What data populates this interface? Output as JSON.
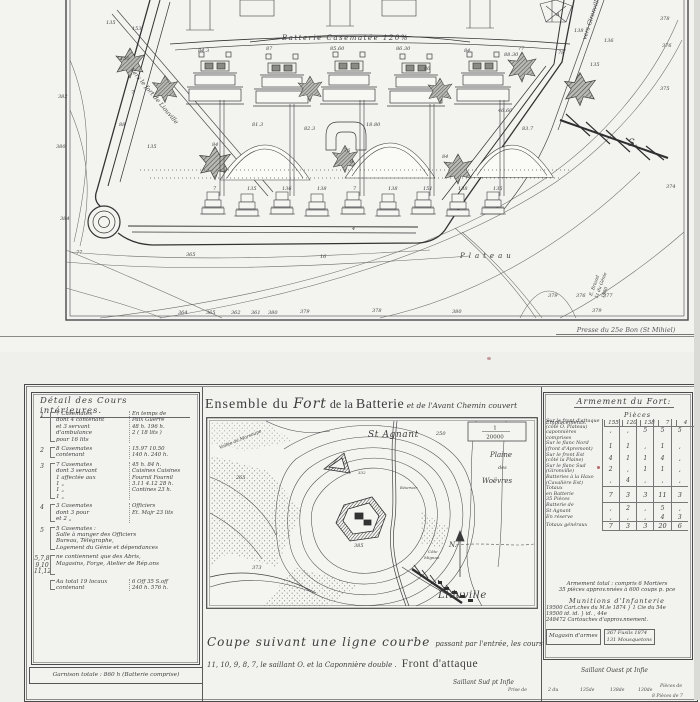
{
  "imprint": "Presse du 25e Bon (St Mihiel)",
  "fort_plan": {
    "top_label": "Batterie Casematée 120%",
    "road_left_label": "Vers le fort de Liouville",
    "road_right_label": "vers Gironville",
    "south_label": "S.",
    "plateau_label": "Plateau",
    "signature": [
      "E. Briand",
      "Lt du Génie",
      "1880"
    ],
    "labels": [
      {
        "t": "135",
        "x": 106,
        "y": 24
      },
      {
        "t": "153",
        "x": 132,
        "y": 30
      },
      {
        "t": "150",
        "x": 120,
        "y": 60
      },
      {
        "t": "7",
        "x": 131,
        "y": 94
      },
      {
        "t": "88",
        "x": 119,
        "y": 126
      },
      {
        "t": "135",
        "x": 147,
        "y": 148
      },
      {
        "t": "382",
        "x": 58,
        "y": 98
      },
      {
        "t": "380",
        "x": 56,
        "y": 148
      },
      {
        "t": "384",
        "x": 60,
        "y": 220
      },
      {
        "t": "77",
        "x": 76,
        "y": 254
      },
      {
        "t": "84.3",
        "x": 198,
        "y": 52
      },
      {
        "t": "87",
        "x": 266,
        "y": 50
      },
      {
        "t": "85.60",
        "x": 330,
        "y": 50
      },
      {
        "t": "86.30",
        "x": 396,
        "y": 50
      },
      {
        "t": "84",
        "x": 464,
        "y": 52
      },
      {
        "t": "86",
        "x": 424,
        "y": 70
      },
      {
        "t": "88.30",
        "x": 504,
        "y": 56
      },
      {
        "t": "A",
        "x": 556,
        "y": 16
      },
      {
        "t": "77",
        "x": 518,
        "y": 50
      },
      {
        "t": "78",
        "x": 558,
        "y": 54
      },
      {
        "t": "135",
        "x": 590,
        "y": 66
      },
      {
        "t": "136",
        "x": 604,
        "y": 42
      },
      {
        "t": "138",
        "x": 574,
        "y": 32
      },
      {
        "t": "81.3",
        "x": 252,
        "y": 126
      },
      {
        "t": "82.3",
        "x": 304,
        "y": 130
      },
      {
        "t": "18.80",
        "x": 366,
        "y": 126
      },
      {
        "t": "76",
        "x": 344,
        "y": 152
      },
      {
        "t": "9",
        "x": 350,
        "y": 163
      },
      {
        "t": "84",
        "x": 212,
        "y": 146
      },
      {
        "t": "84",
        "x": 442,
        "y": 158
      },
      {
        "t": "46.60",
        "x": 498,
        "y": 112
      },
      {
        "t": "83.7",
        "x": 522,
        "y": 130
      },
      {
        "t": "7",
        "x": 213,
        "y": 190
      },
      {
        "t": "135",
        "x": 247,
        "y": 190
      },
      {
        "t": "136",
        "x": 282,
        "y": 190
      },
      {
        "t": "138",
        "x": 317,
        "y": 190
      },
      {
        "t": "7",
        "x": 353,
        "y": 190
      },
      {
        "t": "138",
        "x": 388,
        "y": 190
      },
      {
        "t": "151",
        "x": 423,
        "y": 190
      },
      {
        "t": "138",
        "x": 458,
        "y": 190
      },
      {
        "t": "135",
        "x": 493,
        "y": 190
      },
      {
        "t": "364",
        "x": 178,
        "y": 314
      },
      {
        "t": "365",
        "x": 206,
        "y": 314
      },
      {
        "t": "362",
        "x": 231,
        "y": 314
      },
      {
        "t": "361",
        "x": 251,
        "y": 314
      },
      {
        "t": "380",
        "x": 268,
        "y": 314
      },
      {
        "t": "379",
        "x": 300,
        "y": 313
      },
      {
        "t": "378",
        "x": 372,
        "y": 312
      },
      {
        "t": "380",
        "x": 452,
        "y": 313
      },
      {
        "t": "379",
        "x": 548,
        "y": 297
      },
      {
        "t": "376",
        "x": 576,
        "y": 297
      },
      {
        "t": "377",
        "x": 603,
        "y": 297
      },
      {
        "t": "379",
        "x": 592,
        "y": 312
      },
      {
        "t": "378",
        "x": 660,
        "y": 20
      },
      {
        "t": "376",
        "x": 662,
        "y": 47
      },
      {
        "t": "375",
        "x": 660,
        "y": 90
      },
      {
        "t": "374",
        "x": 666,
        "y": 188
      },
      {
        "t": "16",
        "x": 320,
        "y": 258
      },
      {
        "t": "365",
        "x": 186,
        "y": 256
      },
      {
        "t": "4",
        "x": 352,
        "y": 230
      }
    ]
  },
  "left_table": {
    "title": "Détail des Cours intérieures.",
    "rows": [
      {
        "num": "1",
        "desc": [
          "7 Casemates",
          "dont 4 contenant",
          "et 3 servant",
          "d'ambulance",
          "pour 16 lits"
        ],
        "vals": [
          "En temps de",
          "Paix      Guerre",
          "48 h.      196 h.",
          "2 ( 18 lits )"
        ]
      },
      {
        "num": "2",
        "desc": [
          "8 Casemates",
          "contenant"
        ],
        "vals": [
          "15.97      10.50",
          "140 h.     240 h."
        ]
      },
      {
        "num": "3",
        "desc": [
          "7 Casemates",
          "dont 3 servant",
          "1 affectée aux",
          "1        „",
          "1        „",
          "1        „"
        ],
        "vals": [
          "45 h.       84 h.",
          "Cuisines  Cuisines",
          "Fournil     Fournil",
          "3.11 4.12   28 h.",
          "Cantines    23 h."
        ]
      },
      {
        "num": "4",
        "desc": [
          "3 Casemates",
          "dont 3 pour",
          "et 2        „"
        ],
        "vals": [
          "Officiers",
          "Et. Majr    23 lits"
        ]
      },
      {
        "num": "5",
        "desc": [
          "5 Casemates :",
          "Salle à manger des Officiers",
          "Bureau, Télégraphe,",
          "Logement du Génie et dépendances"
        ],
        "vals": []
      },
      {
        "num": "5,7,8|9,10|11,12",
        "desc": [
          "ne contiennent que des Abris,",
          "Magasins, Forge, Atelier de Rép.ons"
        ],
        "vals": []
      },
      {
        "num": "",
        "desc": [
          "Au total 19 locaux",
          "contenant"
        ],
        "vals": [
          "6 Off      35 S.off",
          "240 h.     576 h."
        ]
      }
    ],
    "garrison": "Garnison totale : 860 h (Batterie comprise)"
  },
  "center": {
    "title_parts": [
      "Ensemble du ",
      "Fort",
      " de la ",
      "Batterie",
      " et de l'Avant Chemin couvert"
    ],
    "scale_top": "1",
    "scale_bottom": "20000",
    "caption_big": "Coupe suivant une ligne courbe",
    "caption_small": " passant par l'entrée, les cours",
    "caption_line2": "11, 10, 9, 8, 7, le saillant O. et la Caponnière double .",
    "caption_front": "Front d'attaque",
    "saillant_sud": "Saillant Sud pt Infie",
    "fragments": [
      {
        "t": "Prise de",
        "x": 508,
        "y": 688
      },
      {
        "t": "2 du",
        "x": 548,
        "y": 688
      },
      {
        "t": "135de",
        "x": 580,
        "y": 688
      },
      {
        "t": "138de",
        "x": 610,
        "y": 688
      },
      {
        "t": "130de",
        "x": 638,
        "y": 688
      },
      {
        "t": "Pièces de",
        "x": 660,
        "y": 684
      },
      {
        "t": "8 Pièces de 7",
        "x": 652,
        "y": 694
      }
    ],
    "map_labels": [
      {
        "t": "St Agnant",
        "x": 162,
        "y": 20,
        "s": 9,
        "cls": "script"
      },
      {
        "t": "250",
        "x": 230,
        "y": 18,
        "s": 5
      },
      {
        "t": "Plaine",
        "x": 284,
        "y": 40,
        "s": 7,
        "cls": "ital"
      },
      {
        "t": "des",
        "x": 292,
        "y": 52,
        "s": 5,
        "cls": "ital"
      },
      {
        "t": "Woëvres",
        "x": 276,
        "y": 66,
        "s": 7,
        "cls": "ital"
      },
      {
        "t": "N.",
        "x": 243,
        "y": 130,
        "s": 7,
        "cls": "ital"
      },
      {
        "t": "Liouville",
        "x": 232,
        "y": 181,
        "s": 10,
        "cls": "script"
      },
      {
        "t": "265",
        "x": 30,
        "y": 62,
        "s": 5
      },
      {
        "t": "373",
        "x": 46,
        "y": 152,
        "s": 5
      },
      {
        "t": "385",
        "x": 148,
        "y": 130,
        "s": 5
      },
      {
        "t": "332",
        "x": 152,
        "y": 57,
        "s": 4
      },
      {
        "t": "Vallée de Marsoupe",
        "x": 14,
        "y": 32,
        "s": 4.5,
        "r": -22,
        "cls": "ital"
      },
      {
        "t": "Côte",
        "x": 222,
        "y": 136,
        "s": 4,
        "cls": "ital"
      },
      {
        "t": "Mignon",
        "x": 218,
        "y": 142,
        "s": 4,
        "cls": "ital"
      },
      {
        "t": "Réservoir",
        "x": 194,
        "y": 72,
        "s": 3.5,
        "cls": "ital"
      }
    ]
  },
  "armament": {
    "title": "Armement du Fort:",
    "pieces_label": "Pièces",
    "emplacement_label": "Emplacements.",
    "columns": [
      "155",
      "120",
      "138",
      "7",
      "4"
    ],
    "rows": [
      {
        "label": [
          "Sur le front d'attaque",
          "(côté O. Plateau)",
          "caponnières comprises"
        ],
        "v": [
          ",",
          ",",
          "5",
          "5",
          "5"
        ]
      },
      {
        "label": [
          "Sur le flanc Nord",
          "(front d'Apremont)"
        ],
        "v": [
          "1",
          "1",
          ",",
          "1",
          ","
        ]
      },
      {
        "label": [
          "Sur le front Est",
          "(côté la Plaine)"
        ],
        "v": [
          "4",
          "1",
          "1",
          "4",
          ","
        ]
      },
      {
        "label": [
          "Sur le flanc Sud",
          "(Gironville)"
        ],
        "v": [
          "2",
          ",",
          "1",
          "1",
          ","
        ]
      },
      {
        "label": [
          "Batteries à la Haxo",
          "(Cavalière Est)"
        ],
        "v": [
          ",",
          "4",
          ",",
          ",",
          ","
        ]
      },
      {
        "label": [
          "Totaux",
          "en Batterie",
          "35 Pièces"
        ],
        "v": [
          "7",
          "3",
          "3",
          "11",
          "3"
        ],
        "cls": "totals"
      },
      {
        "label": [
          "Batterie de",
          "St Agnant"
        ],
        "v": [
          ",",
          "2",
          ",",
          "5",
          ","
        ]
      },
      {
        "label": [
          "En réserve"
        ],
        "v": [
          ",",
          ",",
          ",",
          "4",
          "3"
        ]
      },
      {
        "label": [
          "Totaux généraux"
        ],
        "v": [
          "7",
          "3",
          "3",
          "20",
          "6"
        ],
        "cls": "totals"
      }
    ],
    "notes": [
      "Armement total : compris 6 Mortiers",
      "35 pièces approv.nnées à 600 coups p. pce"
    ],
    "munitions_title": "Munitions  d'Infanterie",
    "munitions_lines": [
      "19500   Cart.ches du M.le 1874  }  1 Cie du 54e",
      "19500      id.          id.          }   id. ,  44e",
      "248472  Cartouches d'approv.nnement."
    ],
    "magasin_label": "Magasin d'armes",
    "magasin_lines": [
      "367   Fusils 1874",
      "131   Mousquetons"
    ],
    "saillant_ouest": "Saillant Ouest pt Infie"
  }
}
